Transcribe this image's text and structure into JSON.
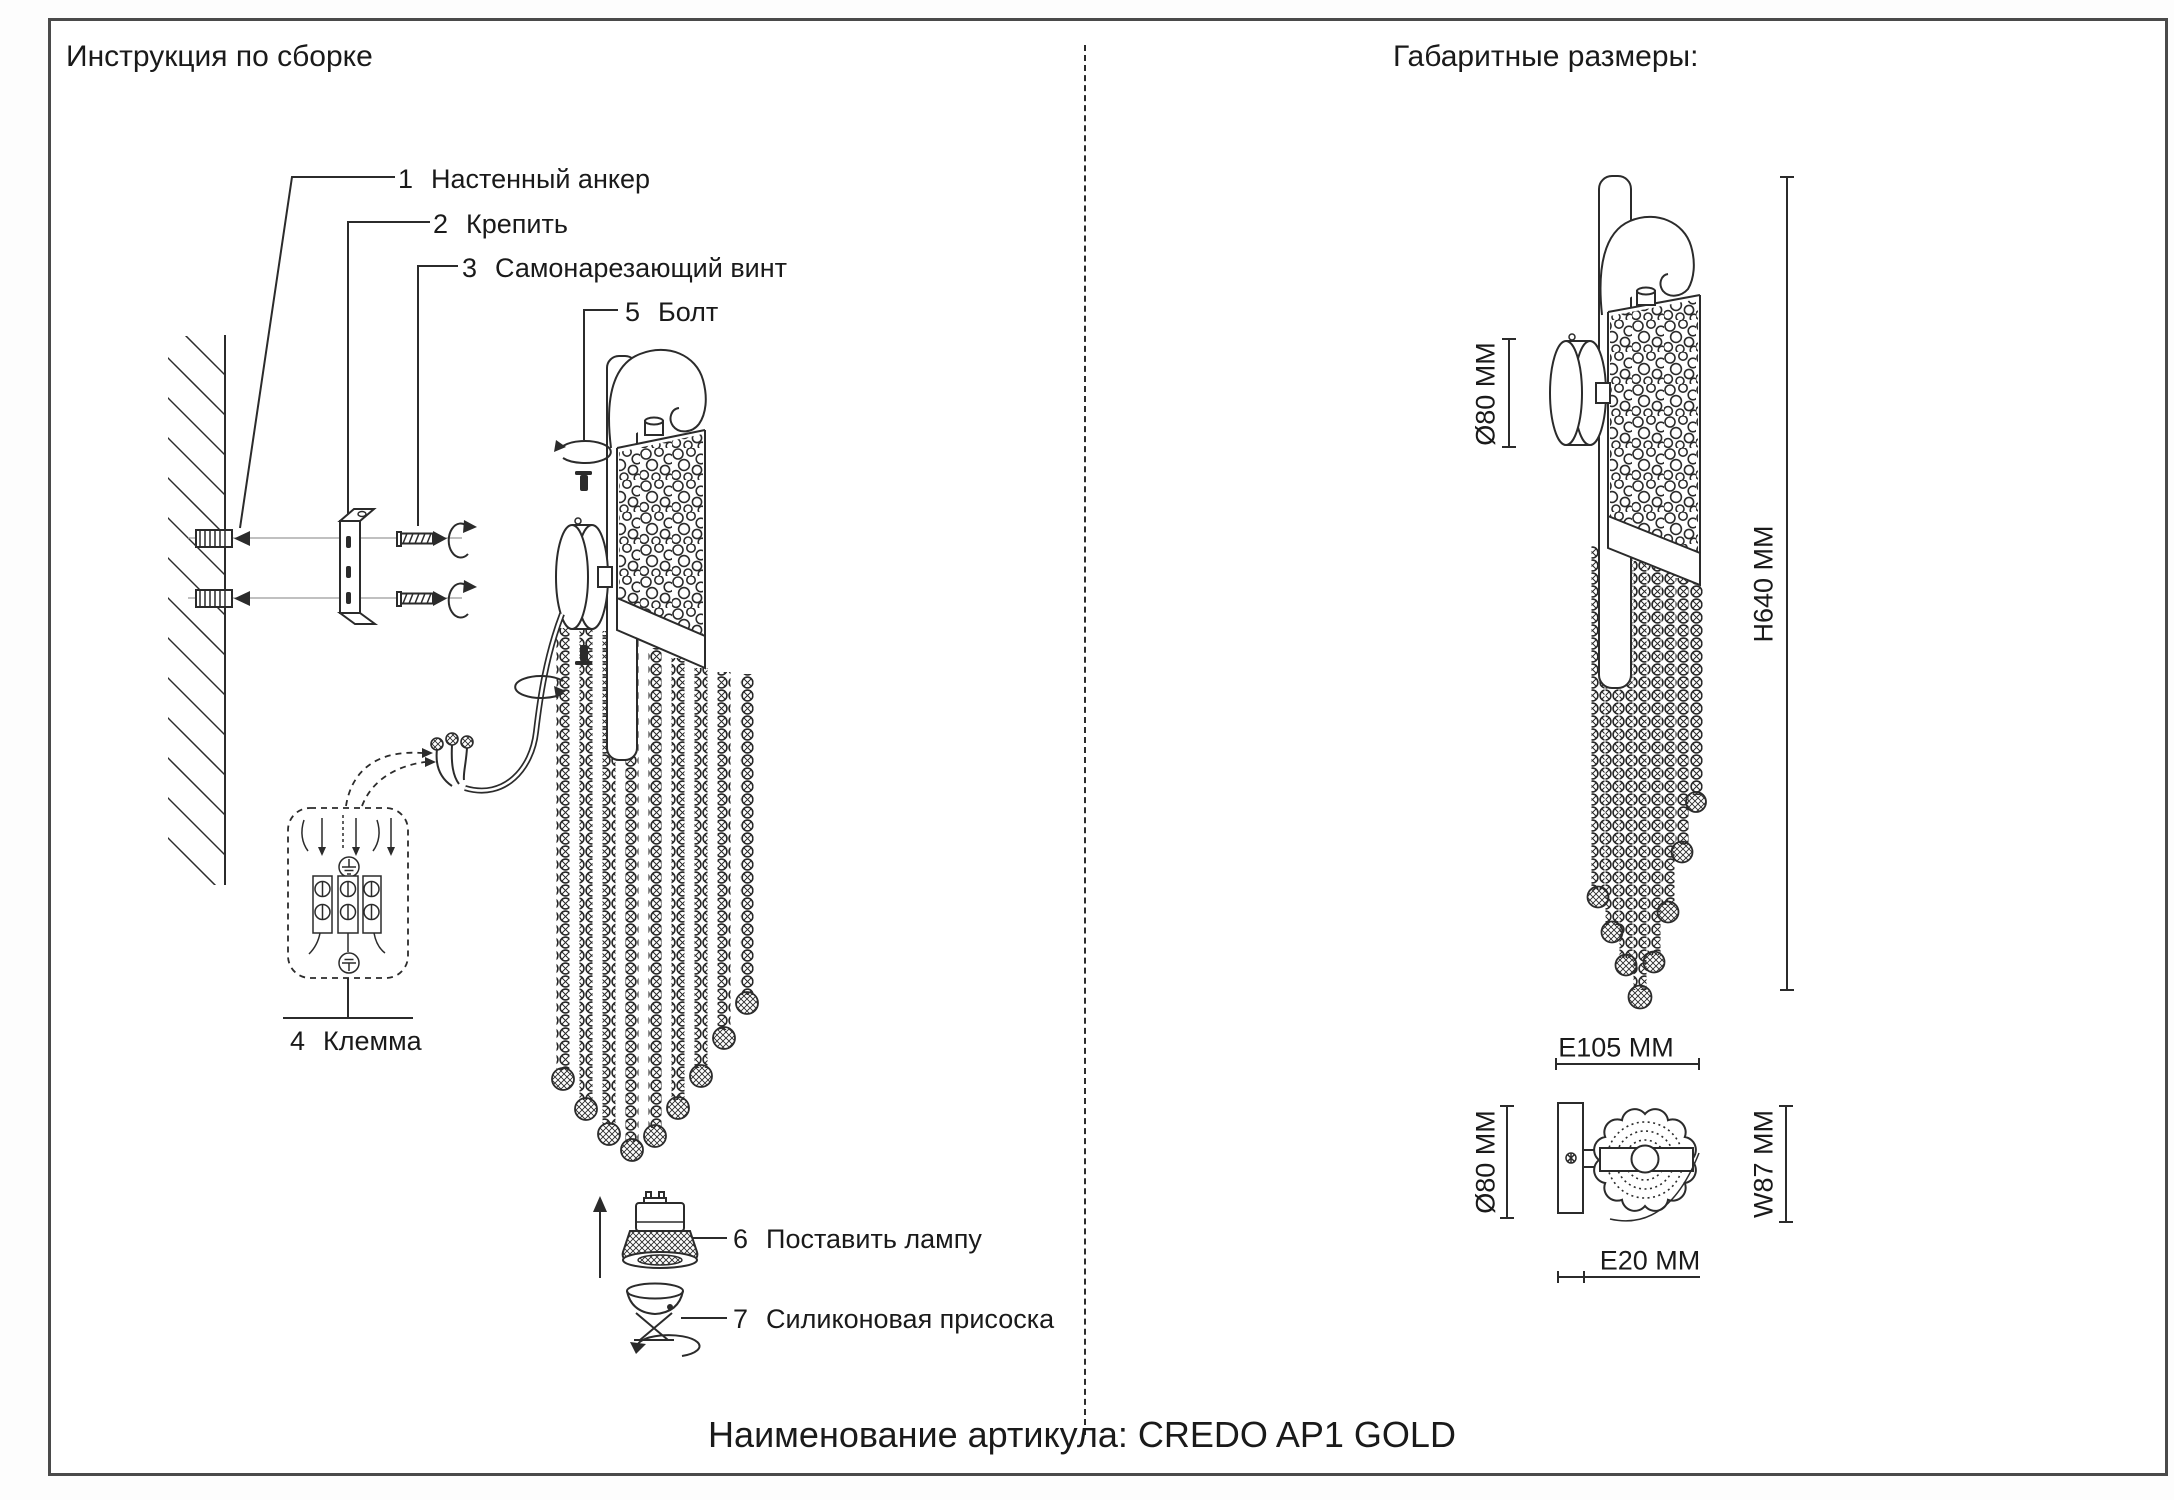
{
  "colors": {
    "ink": "#1a1a1a",
    "line": "#2b2b2b",
    "lightline": "#9a9a9a",
    "frame": "#4a4a4a"
  },
  "left_panel": {
    "title": "Инструкция по сборке",
    "parts": [
      {
        "num": "1",
        "label": "Настенный анкер"
      },
      {
        "num": "2",
        "label": "Крепить"
      },
      {
        "num": "3",
        "label": "Самонарезающий винт"
      },
      {
        "num": "5",
        "label": "Болт"
      },
      {
        "num": "4",
        "label": "Клемма"
      },
      {
        "num": "6",
        "label": "Поставить лампу"
      },
      {
        "num": "7",
        "label": "Силиконовая присоска"
      }
    ]
  },
  "right_panel": {
    "title": "Габаритные размеры:",
    "side_view": {
      "diameter": "Ø80 MM",
      "height": "H640 MM"
    },
    "bottom_view": {
      "extension_top": "E105 MM",
      "diameter": "Ø80 MM",
      "width": "W87 MM",
      "extension_bottom": "E20 MM"
    }
  },
  "footer": {
    "article_label": "Наименование артикула: CREDO AP1 GOLD"
  }
}
